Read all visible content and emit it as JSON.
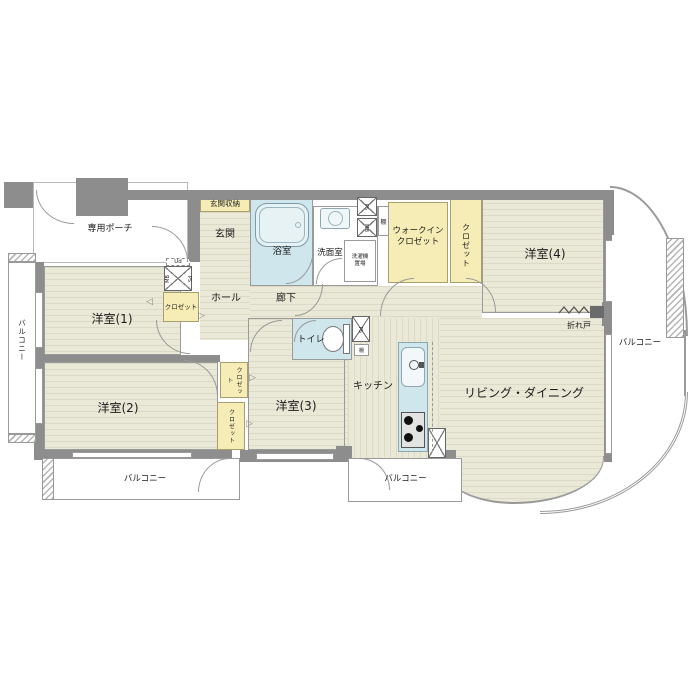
{
  "floorplan": {
    "rooms": {
      "private_porch": "専用ポーチ",
      "entrance_storage": "玄関収納",
      "entrance": "玄関",
      "hall": "ホール",
      "corridor": "廊下",
      "bathroom": "浴室",
      "washroom": "洗面室",
      "toilet": "トイレ",
      "kitchen": "キッチン",
      "living_dining": "リビング・ダイニング",
      "western_room_1": "洋室(1)",
      "western_room_2": "洋室(2)",
      "western_room_3": "洋室(3)",
      "western_room_4": "洋室(4)",
      "walk_in_closet_line1": "ウォークイン",
      "walk_in_closet_line2": "クロゼット",
      "closet": "クロゼット",
      "balcony": "バルコニー"
    },
    "fixtures": {
      "laundry_line1": "洗濯機",
      "laundry_line2": "置場",
      "meter_box": "MB",
      "pipe_space": "PS",
      "shelf": "棚",
      "ud": "Ud",
      "folding_door": "折れ戸"
    },
    "colors": {
      "wall": "#8d8d8d",
      "floor": "#eae8d6",
      "closet": "#f6edb6",
      "wet_area": "#cfe6ec"
    }
  }
}
